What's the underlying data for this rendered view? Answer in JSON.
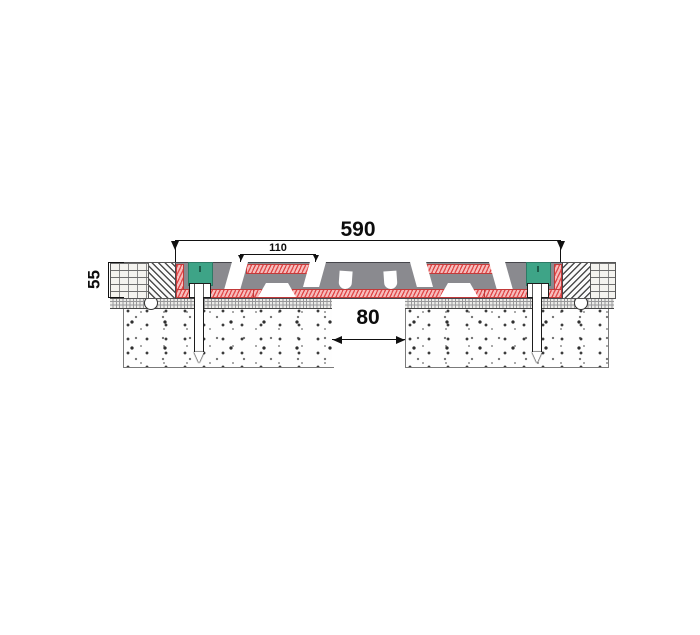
{
  "drawing": {
    "type": "expansion-joint-cross-section",
    "dimensions": {
      "overall_width": "590",
      "insert_width": "110",
      "recess_depth": "55",
      "joint_gap": "80"
    }
  },
  "colors": {
    "profile_gray": "#8a8a8f",
    "seal_red_line": "#e04848",
    "seal_pink_base": "#f6bdbd",
    "anchor_block_green": "#3ea487"
  }
}
